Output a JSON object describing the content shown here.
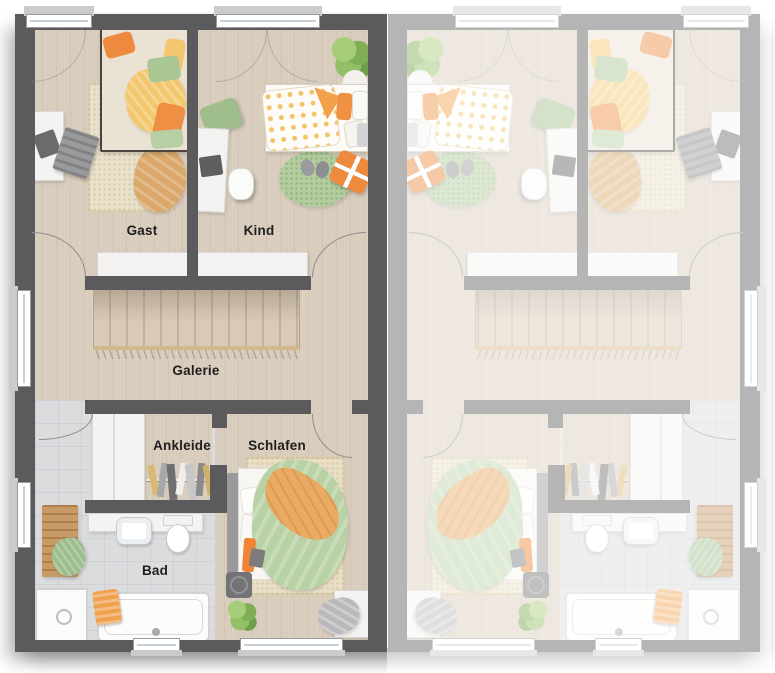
{
  "floorplan": {
    "rooms": {
      "gast": {
        "label": "Gast"
      },
      "kind": {
        "label": "Kind"
      },
      "galerie": {
        "label": "Galerie"
      },
      "ankleide": {
        "label": "Ankleide"
      },
      "schlafen": {
        "label": "Schlafen"
      },
      "bad": {
        "label": "Bad"
      }
    },
    "palette": {
      "wall_dark": "#5b5b5d",
      "wall_faded": "#a7a7a9",
      "floor_wood": "#d9cdbd",
      "floor_tile": "#dbdcde",
      "rug_beige": "#eae1cb",
      "accent_orange": "#ee8a3f",
      "accent_yellow": "#f3c76d",
      "accent_green": "#a9c693",
      "furniture_white": "#f4f3f1"
    }
  }
}
